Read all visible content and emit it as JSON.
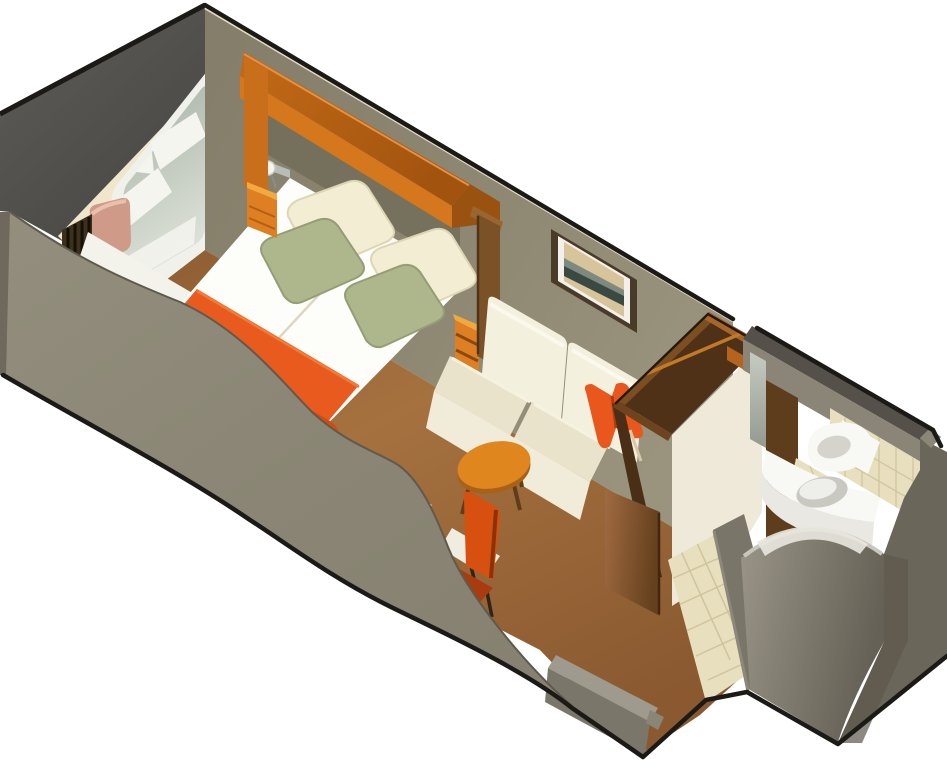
{
  "scene": {
    "type": "isometric-cutaway-floorplan",
    "subject": "cruise-ship stateroom with sitting area and bathroom",
    "view": "dimetric cutaway, front wall sliced away in a curve",
    "background": "#ffffff"
  },
  "colors": {
    "outline": "#1c1a16",
    "hull_top": "#4e4d4a",
    "front_wall": "#8d8877",
    "front_wall_edge": "#6e695c",
    "back_wall": "#8e8873",
    "wall_shadow": "#716b58",
    "cream_trim": "#efe6cb",
    "tan_trim": "#cdb98e",
    "alcove_white": "#eef0e8",
    "window_frame": "#eff1ea",
    "glass_top": "#a3aea1",
    "glass_bottom": "#e0e5db",
    "reflection_white": "#f4f5ef",
    "cushion_pink": "#d09a88",
    "curtain": "#3e3019",
    "curtain_pleat": "#15100a",
    "canopy_top": "#b06016",
    "canopy_face": "#d4771d",
    "canopy_support": "#c96f1c",
    "divider_panel": "#7b5128",
    "nightstand": "#df7f24",
    "nightstand_side": "#bb6114",
    "lamp_white": "#f4f4f0",
    "bed_white": "#fdfdf9",
    "bed_side": "#f3f0e2",
    "runner_orange": "#e85a1e",
    "runner_dark": "#d14c12",
    "pillow_cream": "#f3edd3",
    "pillow_green": "#aeb68c",
    "sofa_back": "#f4f0de",
    "sofa_seat": "#e9e3cb",
    "sofa_base": "#f1ecd9",
    "throw_pillow": "#e9571d",
    "table_top": "#e0861f",
    "table_leg": "#5f3d18",
    "chair_red": "#d8500f",
    "chair_seat": "#a83c10",
    "desk_white": "#f2efe4",
    "desk_side": "#dcd7c5",
    "floor_carpet": "#9a6539",
    "floor_shadow": "#6e4a2c",
    "seat_bench": "#f3f3ec",
    "bench_face": "#e9e3cd",
    "wardrobe_side": "#4a2f16",
    "wardrobe_door": "#8a5a33",
    "wardrobe_face": "#efe9da",
    "wardrobe_interior": "#4f3117",
    "wardrobe_rim": "#7c4e22",
    "wardrobe_rail": "#c07a28",
    "lintel_orange": "#b5641f",
    "bath_wall_dark": "#55514a",
    "bath_wall_inner": "#8b8577",
    "mirror_gray": "#b9beb5",
    "bath_brown": "#5e3d1d",
    "tile_beige": "#e7dfbd",
    "tile_grid": "#c9bd96",
    "fixture_white": "#f8f8f4",
    "fixture_shade": "#d4d4cd",
    "shower_gray": "#948f82",
    "shower_dark": "#6b665a",
    "parapet_top": "#9e9a8d",
    "parapet_face": "#7b766a",
    "right_mass": "#6b665a",
    "hall_wall": "#7a7569"
  },
  "elements": [
    {
      "name": "picture-window",
      "label": "Picture window with sea view"
    },
    {
      "name": "window-seat",
      "label": "Window seat with cushion"
    },
    {
      "name": "curtains",
      "label": "Blackout curtains"
    },
    {
      "name": "bed",
      "label": "Double bed with runner and four pillows"
    },
    {
      "name": "nightstands",
      "label": "Two bedside tables with lamp"
    },
    {
      "name": "canopy",
      "label": "Overhead headboard canopy"
    },
    {
      "name": "sofa",
      "label": "Two-seat sofa with throw pillow"
    },
    {
      "name": "picture-frame",
      "label": "Framed artwork"
    },
    {
      "name": "coffee-table",
      "label": "Round coffee table"
    },
    {
      "name": "desk-chair",
      "label": "Desk and chair"
    },
    {
      "name": "wardrobe",
      "label": "Open-top wardrobe with rail"
    },
    {
      "name": "bathroom",
      "label": "Bathroom with vanity, toilet and round shower"
    },
    {
      "name": "entry-hall",
      "label": "Tiled entry hall"
    }
  ]
}
